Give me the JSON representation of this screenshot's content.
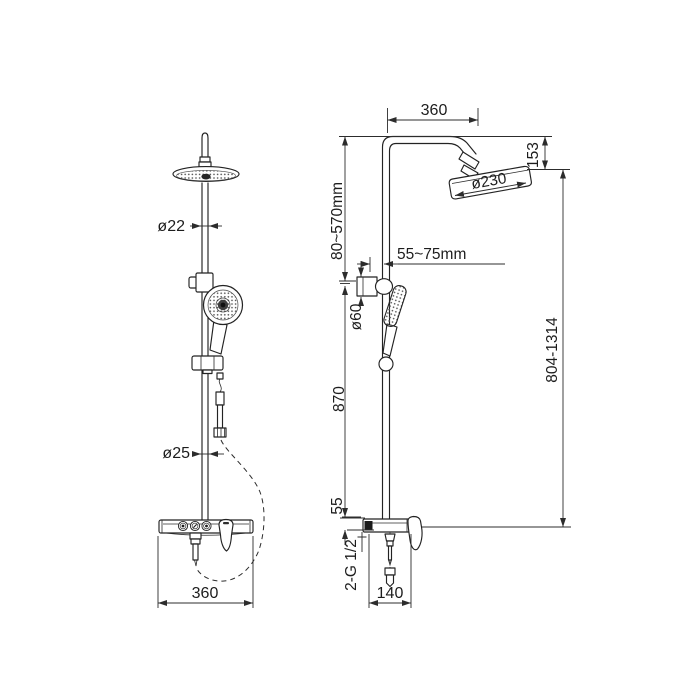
{
  "drawing": {
    "front": {
      "pipe_upper_dia": "ø22",
      "pipe_lower_dia": "ø25",
      "width": "360"
    },
    "side": {
      "arm_width": "360",
      "head_height": "153",
      "head_dia": "ø230",
      "holder_range": "80~570mm",
      "wall_distance": "55~75mm",
      "holder_dia": "ø60",
      "lower_column": "870",
      "height_range": "804-1314",
      "deck_thickness": "55",
      "thread": "2-G 1/2",
      "deck_depth": "140"
    },
    "colors": {
      "line": "#232323",
      "background": "#ffffff"
    }
  }
}
